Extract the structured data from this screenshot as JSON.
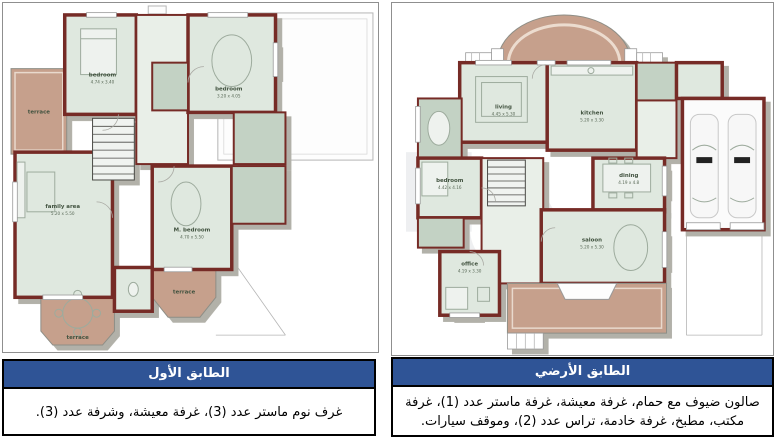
{
  "colors": {
    "caption_header_blue": "#2f5496",
    "wall_maroon": "#762b26",
    "room_green": "#dfe8df",
    "tiled_green": "#c3d2c4",
    "terrace_tan": "#c6a08c",
    "shadow_gray": "#b2b1a9"
  },
  "left_panel": {
    "caption": {
      "title": "الطابق الأول",
      "body": "غرف نوم ماستر عدد (3)، غرفة معيشة، وشرفة عدد (3)."
    },
    "rooms": {
      "bedroom1": {
        "label": "bedroom",
        "dims": "4.74 x 3.40"
      },
      "bedroom2": {
        "label": "bedroom",
        "dims": "3.20 x 4.05"
      },
      "family": {
        "label": "family area",
        "dims": "5.20 x 5.50"
      },
      "master": {
        "label": "M. bedroom",
        "dims": "4.70 x 5.50"
      },
      "terrace_left": {
        "label": "terrace"
      },
      "terrace_bay": {
        "label": "terrace"
      },
      "terrace_rear": {
        "label": "terrace"
      }
    }
  },
  "right_panel": {
    "caption": {
      "title": "الطابق الأرضي",
      "body": "صالون ضيوف مع حمام، غرفة معيشة، غرفة ماستر عدد (1)، غرفة مكتب، مطبخ، غرفة خادمة، تراس عدد (2)، وموقف سيارات."
    },
    "rooms": {
      "living": {
        "label": "living",
        "dims": "4.45 x 5.30"
      },
      "kitchen": {
        "label": "kitchen",
        "dims": "5.20 x 3.30"
      },
      "dining": {
        "label": "dining",
        "dims": "4.19 x 4.8"
      },
      "saloon": {
        "label": "saloon",
        "dims": "5.20 x 5.30"
      },
      "bedroom": {
        "label": "bedroom",
        "dims": "4.42 x 4.16"
      },
      "office": {
        "label": "office",
        "dims": "4.19 x 3.30"
      }
    }
  }
}
